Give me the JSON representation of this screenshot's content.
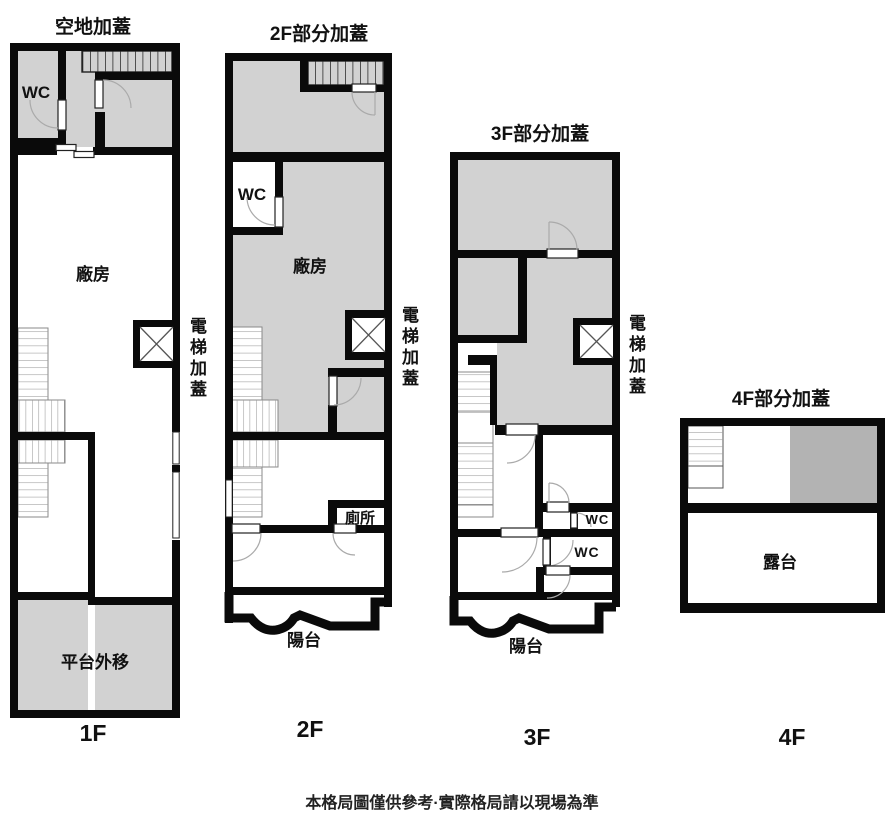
{
  "floors": [
    {
      "title": "空地加蓋",
      "floor_label": "1F",
      "rooms": {
        "wc": "WC",
        "factory": "廠房",
        "elevator": "電梯加蓋",
        "platform": "平台外移"
      }
    },
    {
      "title": "2F部分加蓋",
      "floor_label": "2F",
      "rooms": {
        "wc": "WC",
        "factory": "廠房",
        "elevator": "電梯加蓋",
        "toilet": "廁所",
        "balcony": "陽台"
      }
    },
    {
      "title": "3F部分加蓋",
      "floor_label": "3F",
      "rooms": {
        "elevator": "電梯加蓋",
        "wc_upper": "WC",
        "wc_lower": "WC",
        "balcony": "陽台"
      }
    },
    {
      "title": "4F部分加蓋",
      "floor_label": "4F",
      "rooms": {
        "terrace": "露台"
      }
    }
  ],
  "footer": {
    "disclaimer": "本格局圖僅供參考·實際格局請以現場為準"
  },
  "colors": {
    "wall": "#0a0a0a",
    "room_fill": "#d2d2d2",
    "room_fill_dark": "#b3b3b3",
    "background": "#ffffff"
  }
}
